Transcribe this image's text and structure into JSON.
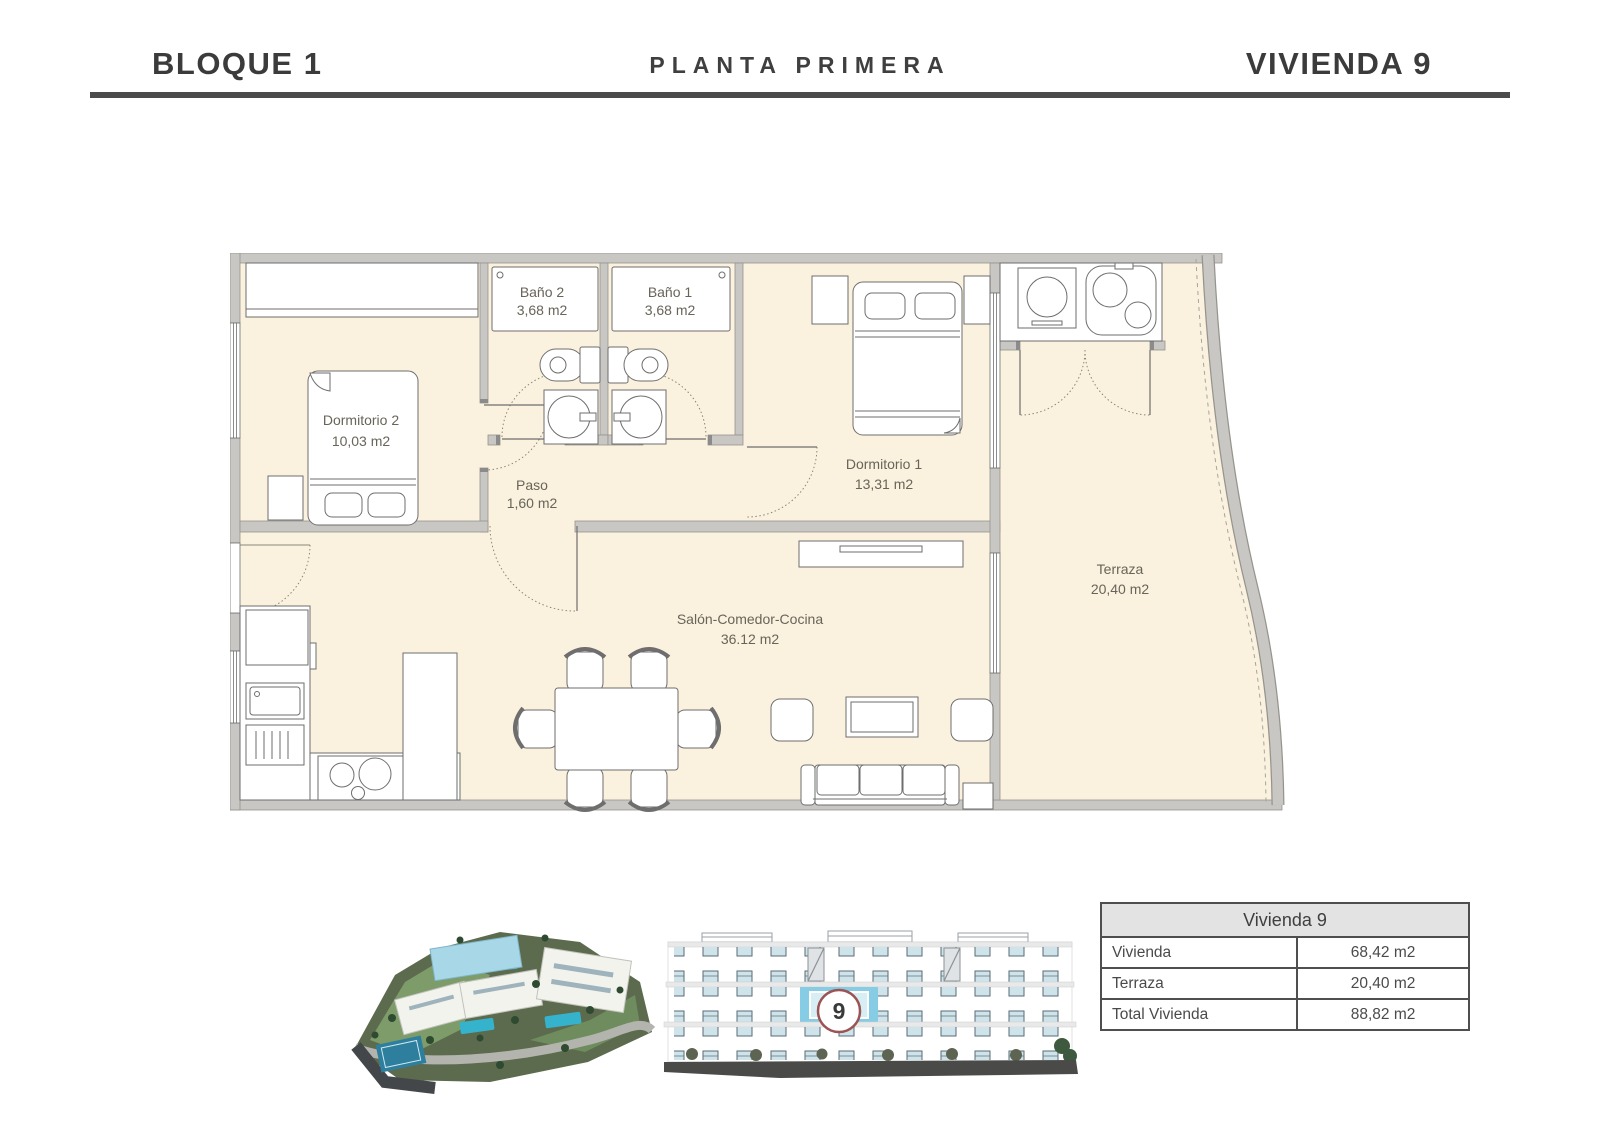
{
  "header": {
    "block": "BLOQUE 1",
    "floor": "PLANTA PRIMERA",
    "unit": "VIVIENDA 9"
  },
  "plan": {
    "rooms": [
      {
        "id": "bano2",
        "name": "Baño 2",
        "area": "3,68 m2"
      },
      {
        "id": "bano1",
        "name": "Baño 1",
        "area": "3,68 m2"
      },
      {
        "id": "dormitorio2",
        "name": "Dormitorio 2",
        "area": "10,03 m2"
      },
      {
        "id": "paso",
        "name": "Paso",
        "area": "1,60 m2"
      },
      {
        "id": "dormitorio1",
        "name": "Dormitorio 1",
        "area": "13,31 m2"
      },
      {
        "id": "salon",
        "name": "Salón-Comedor-Cocina",
        "area": "36.12 m2"
      },
      {
        "id": "terraza",
        "name": "Terraza",
        "area": "20,40 m2"
      }
    ]
  },
  "elevation": {
    "badge": "9"
  },
  "table": {
    "title": "Vivienda 9",
    "rows": [
      {
        "label": "Vivienda",
        "value": "68,42 m2"
      },
      {
        "label": "Terraza",
        "value": "20,40 m2"
      },
      {
        "label": "Total Vivienda",
        "value": "88,82 m2"
      }
    ]
  },
  "colors": {
    "floor_cream": "#faf2de",
    "wall_gray": "#c8c7c4",
    "divider": "#4b4b4b",
    "highlight_blue": "#85cce4",
    "badge_border": "#9b5353",
    "pool_teal": "#35b3cc"
  }
}
